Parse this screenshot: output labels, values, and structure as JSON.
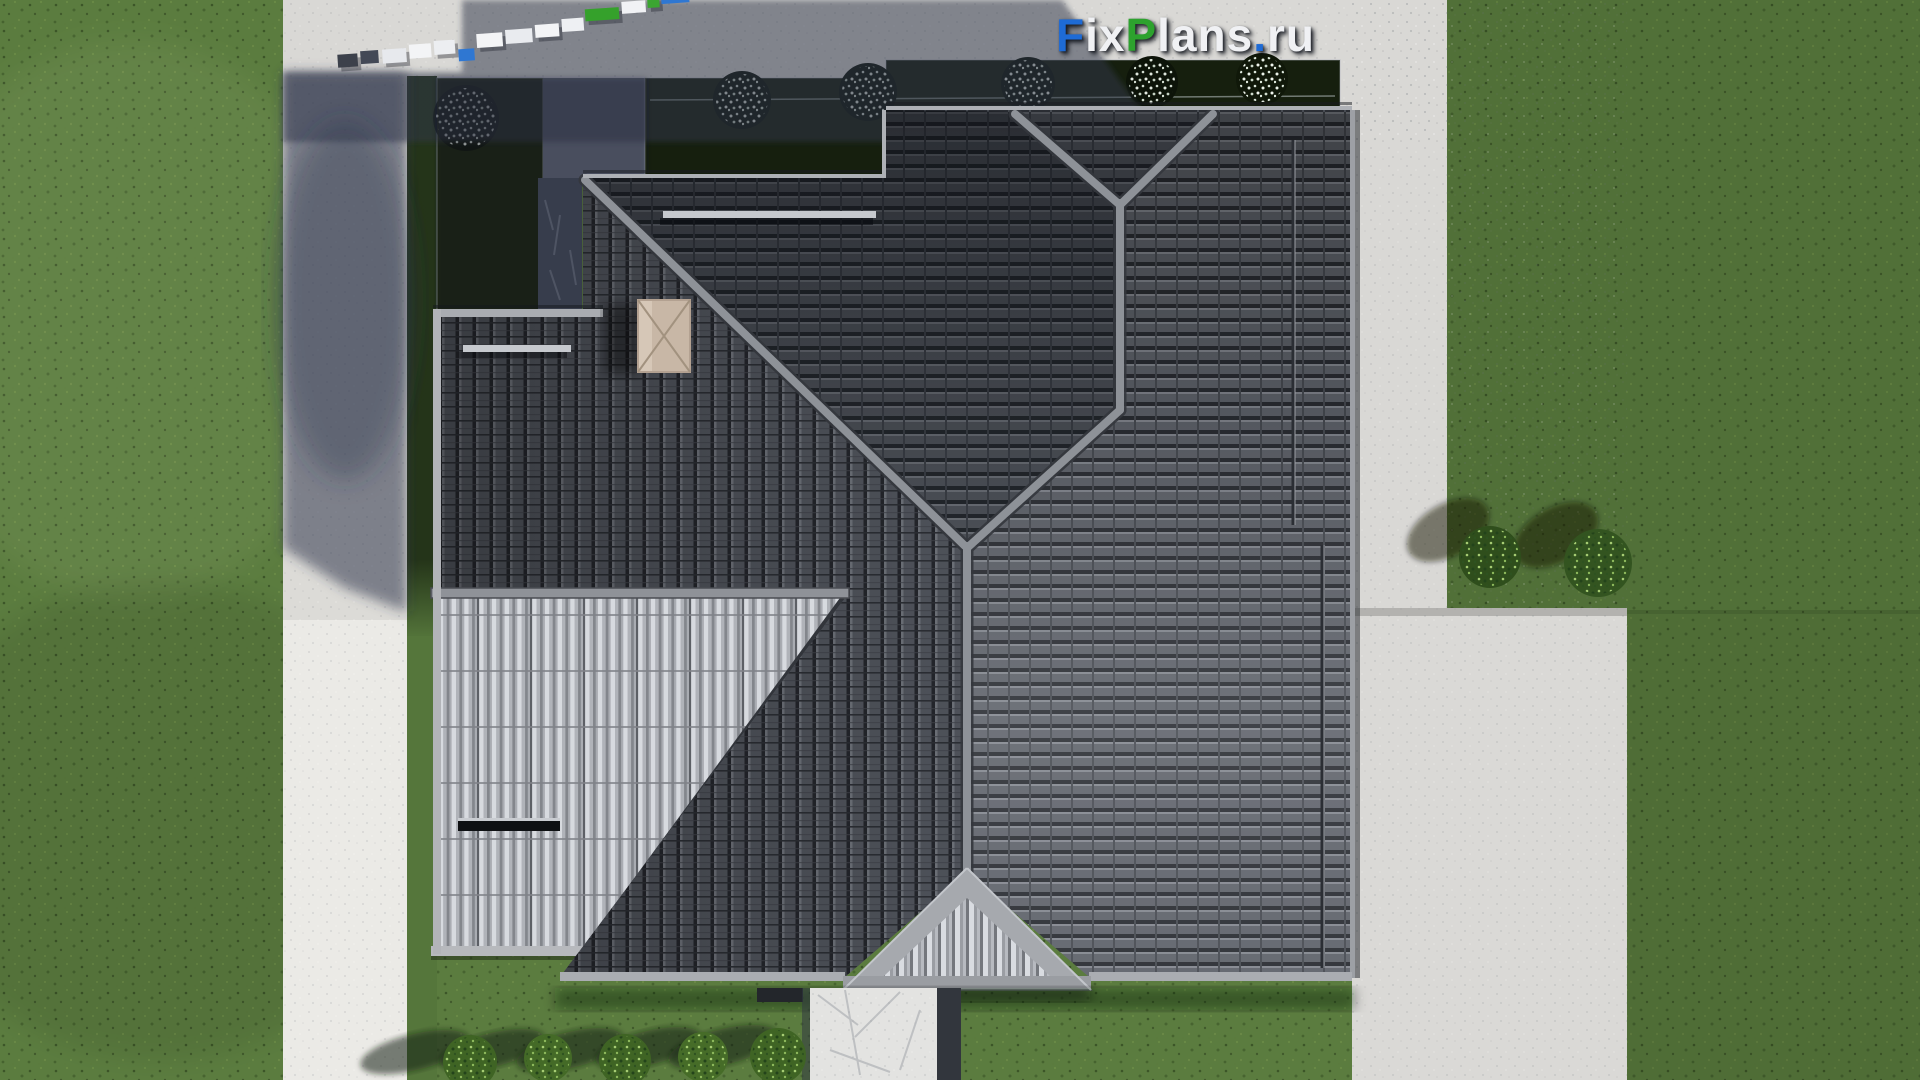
{
  "watermark": {
    "text": "FixPlans.ru",
    "segments": [
      {
        "t": "F",
        "c": "#1e6bd6"
      },
      {
        "t": "ix",
        "c": "#f0f1f4"
      },
      {
        "t": "P",
        "c": "#2da22e"
      },
      {
        "t": "lans",
        "c": "#f0f1f4"
      },
      {
        "t": ".",
        "c": "#1e6bd6"
      },
      {
        "t": "ru",
        "c": "#f0f1f4"
      }
    ]
  },
  "palette": {
    "lawn_green": "#5b7c3f",
    "lawn_dark_bed": "#17210e",
    "pavement_lit": "#dad9d6",
    "pavement_shadow": "#4e5668",
    "roof_tile_dark": "#5f636b",
    "roof_tile_shadow": "#2a2d33",
    "roof_ridge": "#8e9298",
    "terrace_roof_light": "#a9acb2",
    "chimney_beige": "#c8b7a6",
    "walkway": "#e3e3e1",
    "logo_blue": "#1e6bd6",
    "logo_green": "#2da22e",
    "logo_white": "#f0f1f4"
  }
}
